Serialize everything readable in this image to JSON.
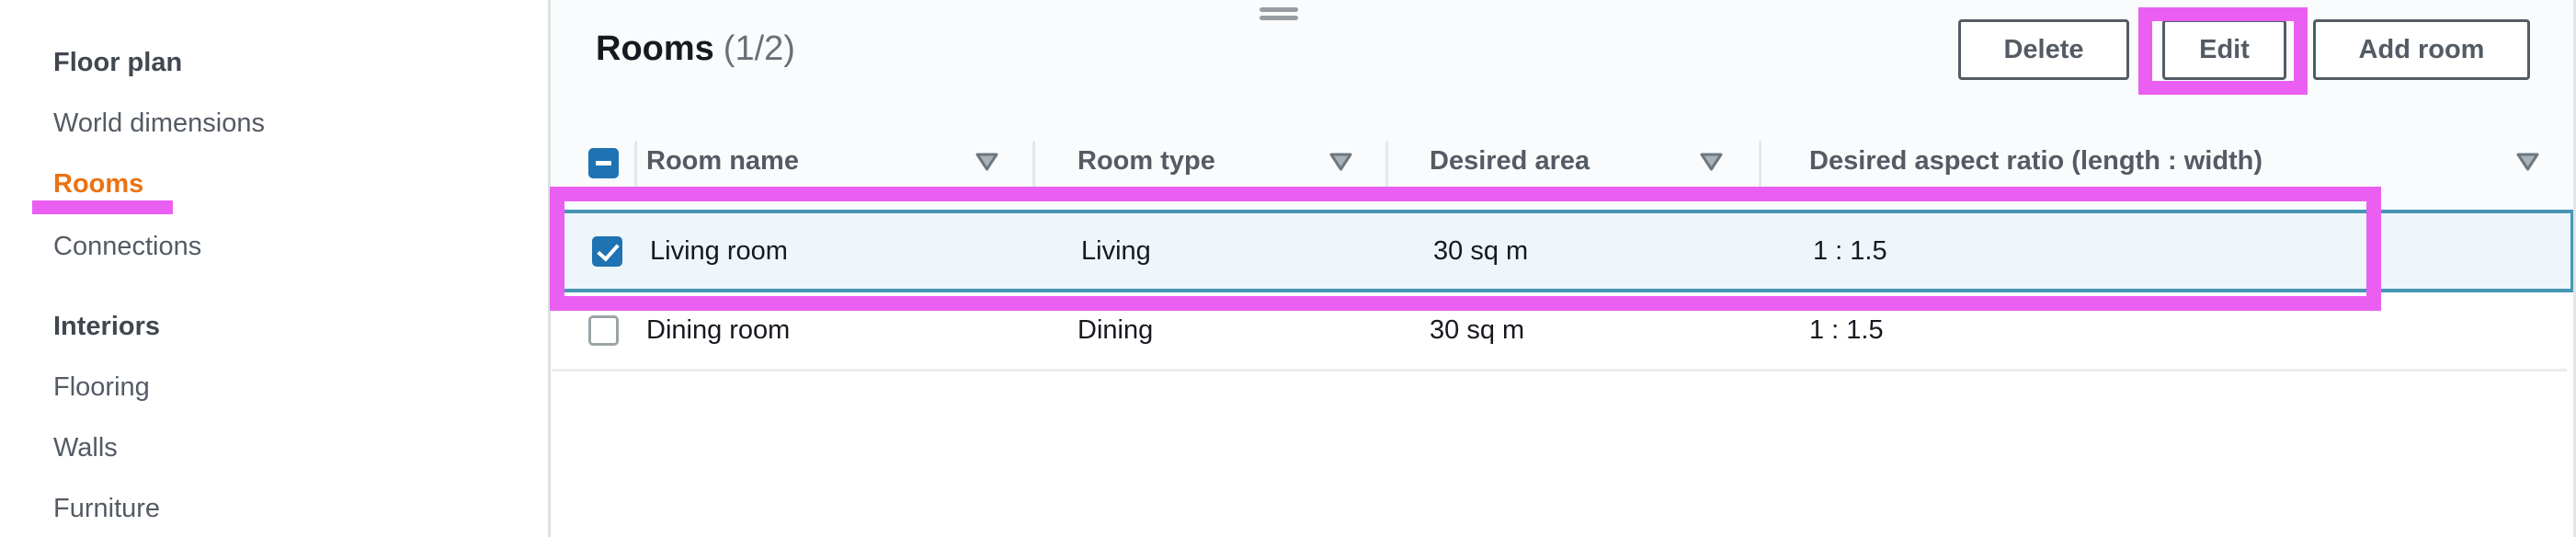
{
  "sidebar": {
    "items": [
      {
        "label": "Floor plan",
        "type": "heading"
      },
      {
        "label": "World dimensions",
        "type": "link"
      },
      {
        "label": "Rooms",
        "type": "link",
        "active": true
      },
      {
        "label": "Connections",
        "type": "link"
      },
      {
        "label": "Interiors",
        "type": "heading"
      },
      {
        "label": "Flooring",
        "type": "link"
      },
      {
        "label": "Walls",
        "type": "link"
      },
      {
        "label": "Furniture",
        "type": "link"
      }
    ]
  },
  "panel": {
    "title": "Rooms",
    "counter": "(1/2)",
    "buttons": {
      "delete": "Delete",
      "edit": "Edit",
      "add": "Add room"
    }
  },
  "table": {
    "columns": [
      "Room name",
      "Room type",
      "Desired area",
      "Desired aspect ratio (length : width)"
    ],
    "rows": [
      {
        "name": "Living room",
        "type": "Living",
        "area": "30 sq m",
        "ratio": "1 : 1.5",
        "selected": true
      },
      {
        "name": "Dining room",
        "type": "Dining",
        "area": "30 sq m",
        "ratio": "1 : 1.5",
        "selected": false
      }
    ],
    "selection": {
      "header_checkbox_state": "indeterminate"
    }
  },
  "icons": {
    "column_filter": "triangle-down-icon",
    "resize_handle": "split-panel-drag-handle-icon"
  },
  "colors": {
    "annotation_highlight": "#ea5ff2",
    "active_nav": "#ec7211",
    "selected_row_border": "#4696b4",
    "selected_row_bg": "#eef6fb",
    "checkbox_blue": "#1f73b3",
    "button_border": "#545b64"
  }
}
